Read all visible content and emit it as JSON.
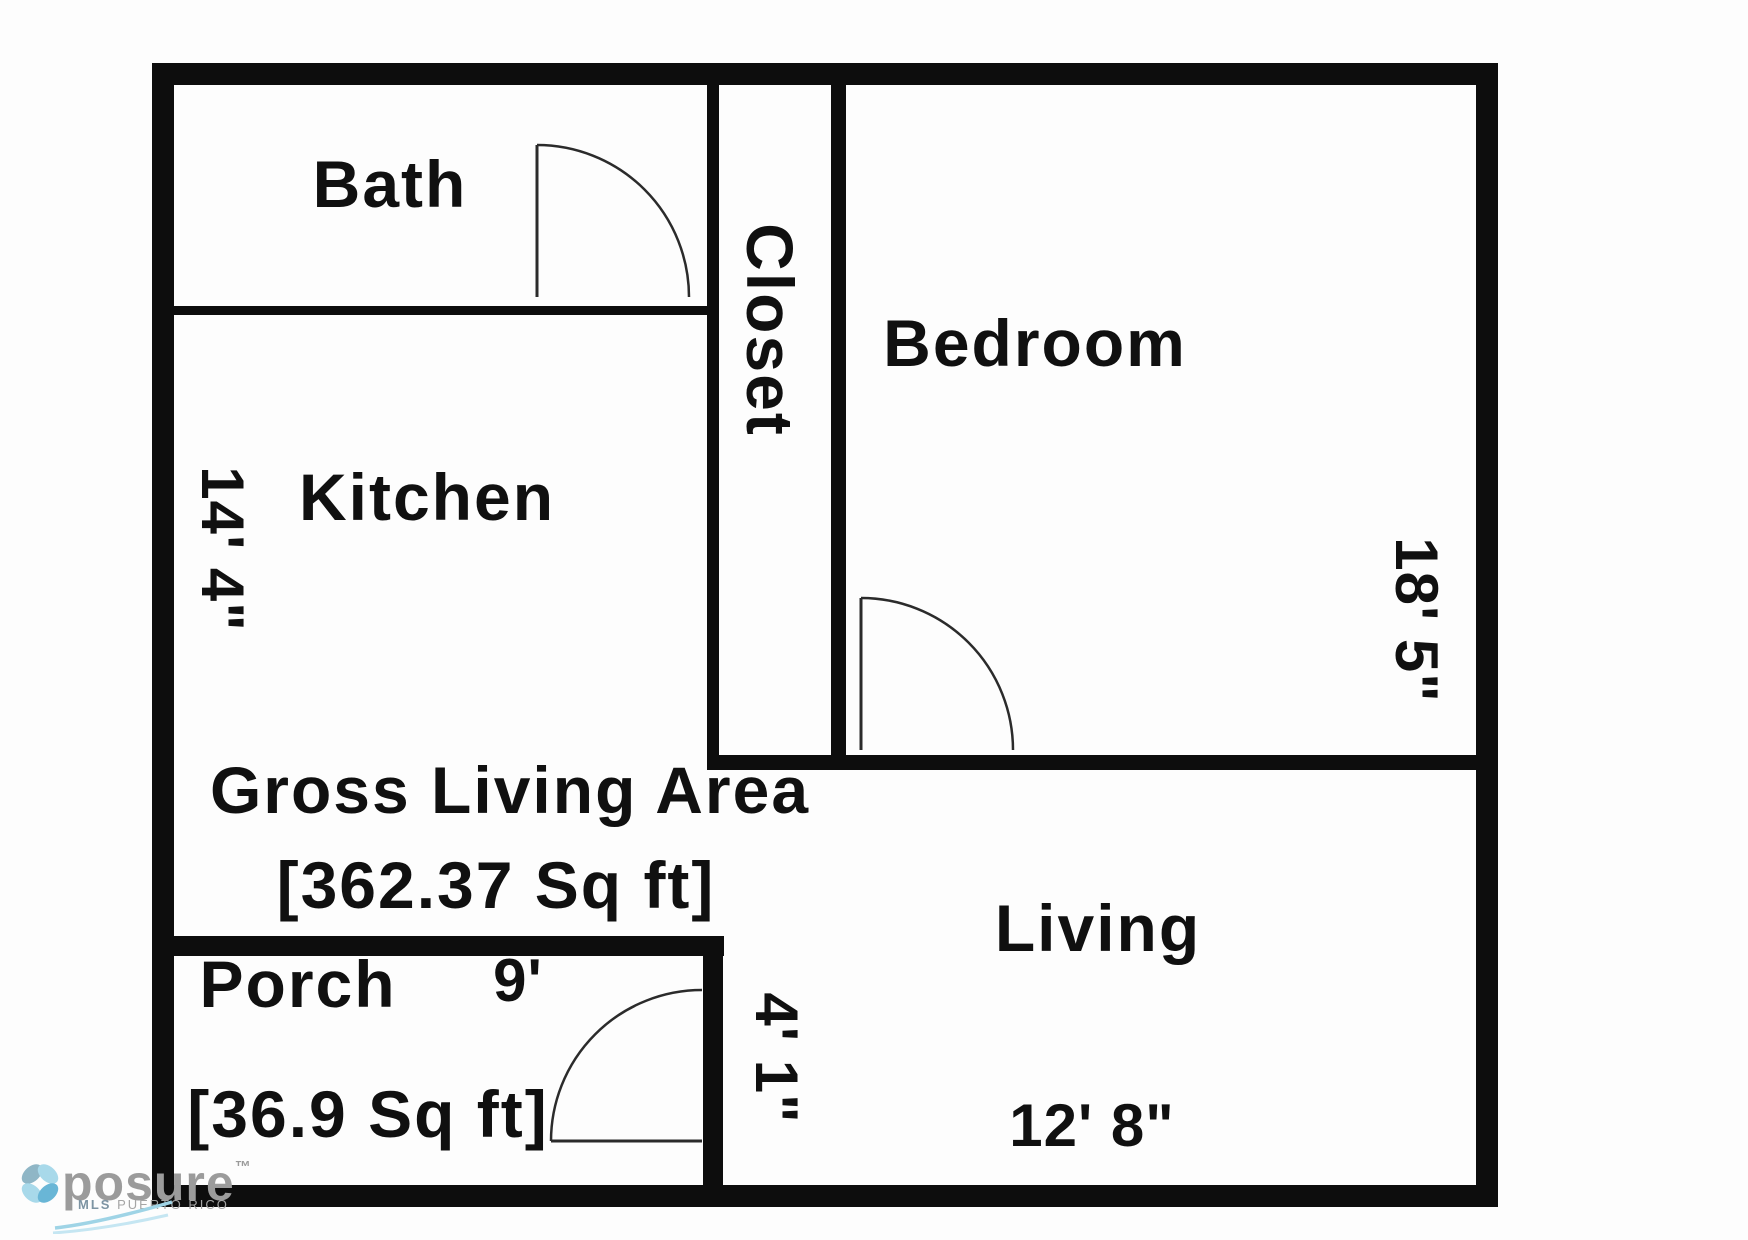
{
  "plan": {
    "wall_color": "#0d0d0d",
    "labels": {
      "bath": "Bath",
      "closet": "Closet",
      "bedroom": "Bedroom",
      "kitchen": "Kitchen",
      "living": "Living",
      "porch": "Porch"
    },
    "dimensions": {
      "kitchen_side": "14' 4\"",
      "bedroom_side": "18' 5\"",
      "porch_width": "9'",
      "porch_depth": "4' 1\"",
      "living_width": "12' 8\""
    },
    "areas": {
      "gross_living_title": "Gross Living Area",
      "gross_living_value": "[362.37 Sq ft]",
      "porch_value": "[36.9 Sq ft]"
    }
  },
  "watermark": {
    "brand": "posure",
    "tm": "™",
    "subtitle_bold": "MLS",
    "subtitle_rest": "PUERTO RICO",
    "colors": {
      "petal_light": "#a8d9ea",
      "petal_mid": "#69b6d6",
      "petal_gray": "#8fb6c6",
      "swoosh_light": "#9fd4e6",
      "swoosh_pale": "#c5e6f2",
      "text_gray": "#9b9b9b"
    }
  }
}
